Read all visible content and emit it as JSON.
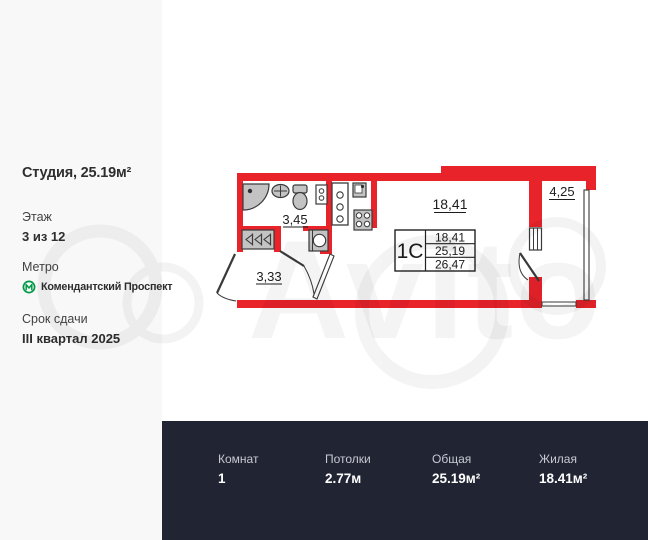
{
  "sidebar": {
    "title": "Студия, 25.19м²",
    "floor": {
      "label": "Этаж",
      "value": "3 из 12"
    },
    "metro": {
      "label": "Метро",
      "station": "Комендантский Проспект"
    },
    "deadline": {
      "label": "Срок сдачи",
      "value": "III квартал 2025"
    }
  },
  "plan": {
    "room_area": "18,41",
    "bathroom_area": "3,45",
    "hallway_area": "3,33",
    "balcony_area": "4,25",
    "spec_table": {
      "type": "1С",
      "rows": [
        "18,41",
        "25,19",
        "26,47"
      ]
    }
  },
  "watermark": {
    "text": "Avito"
  },
  "footer": {
    "stats": [
      {
        "label": "Комнат",
        "value": "1"
      },
      {
        "label": "Потолки",
        "value": "2.77м"
      },
      {
        "label": "Общая",
        "value": "25.19м²"
      },
      {
        "label": "Жилая",
        "value": "18.41м²"
      }
    ]
  },
  "colors": {
    "wall_red": "#e8232a",
    "footer_bg": "#212533",
    "sidebar_bg": "#f8f8f8",
    "metro_green": "#009a47",
    "fixture_gray": "#c3c3c3"
  }
}
